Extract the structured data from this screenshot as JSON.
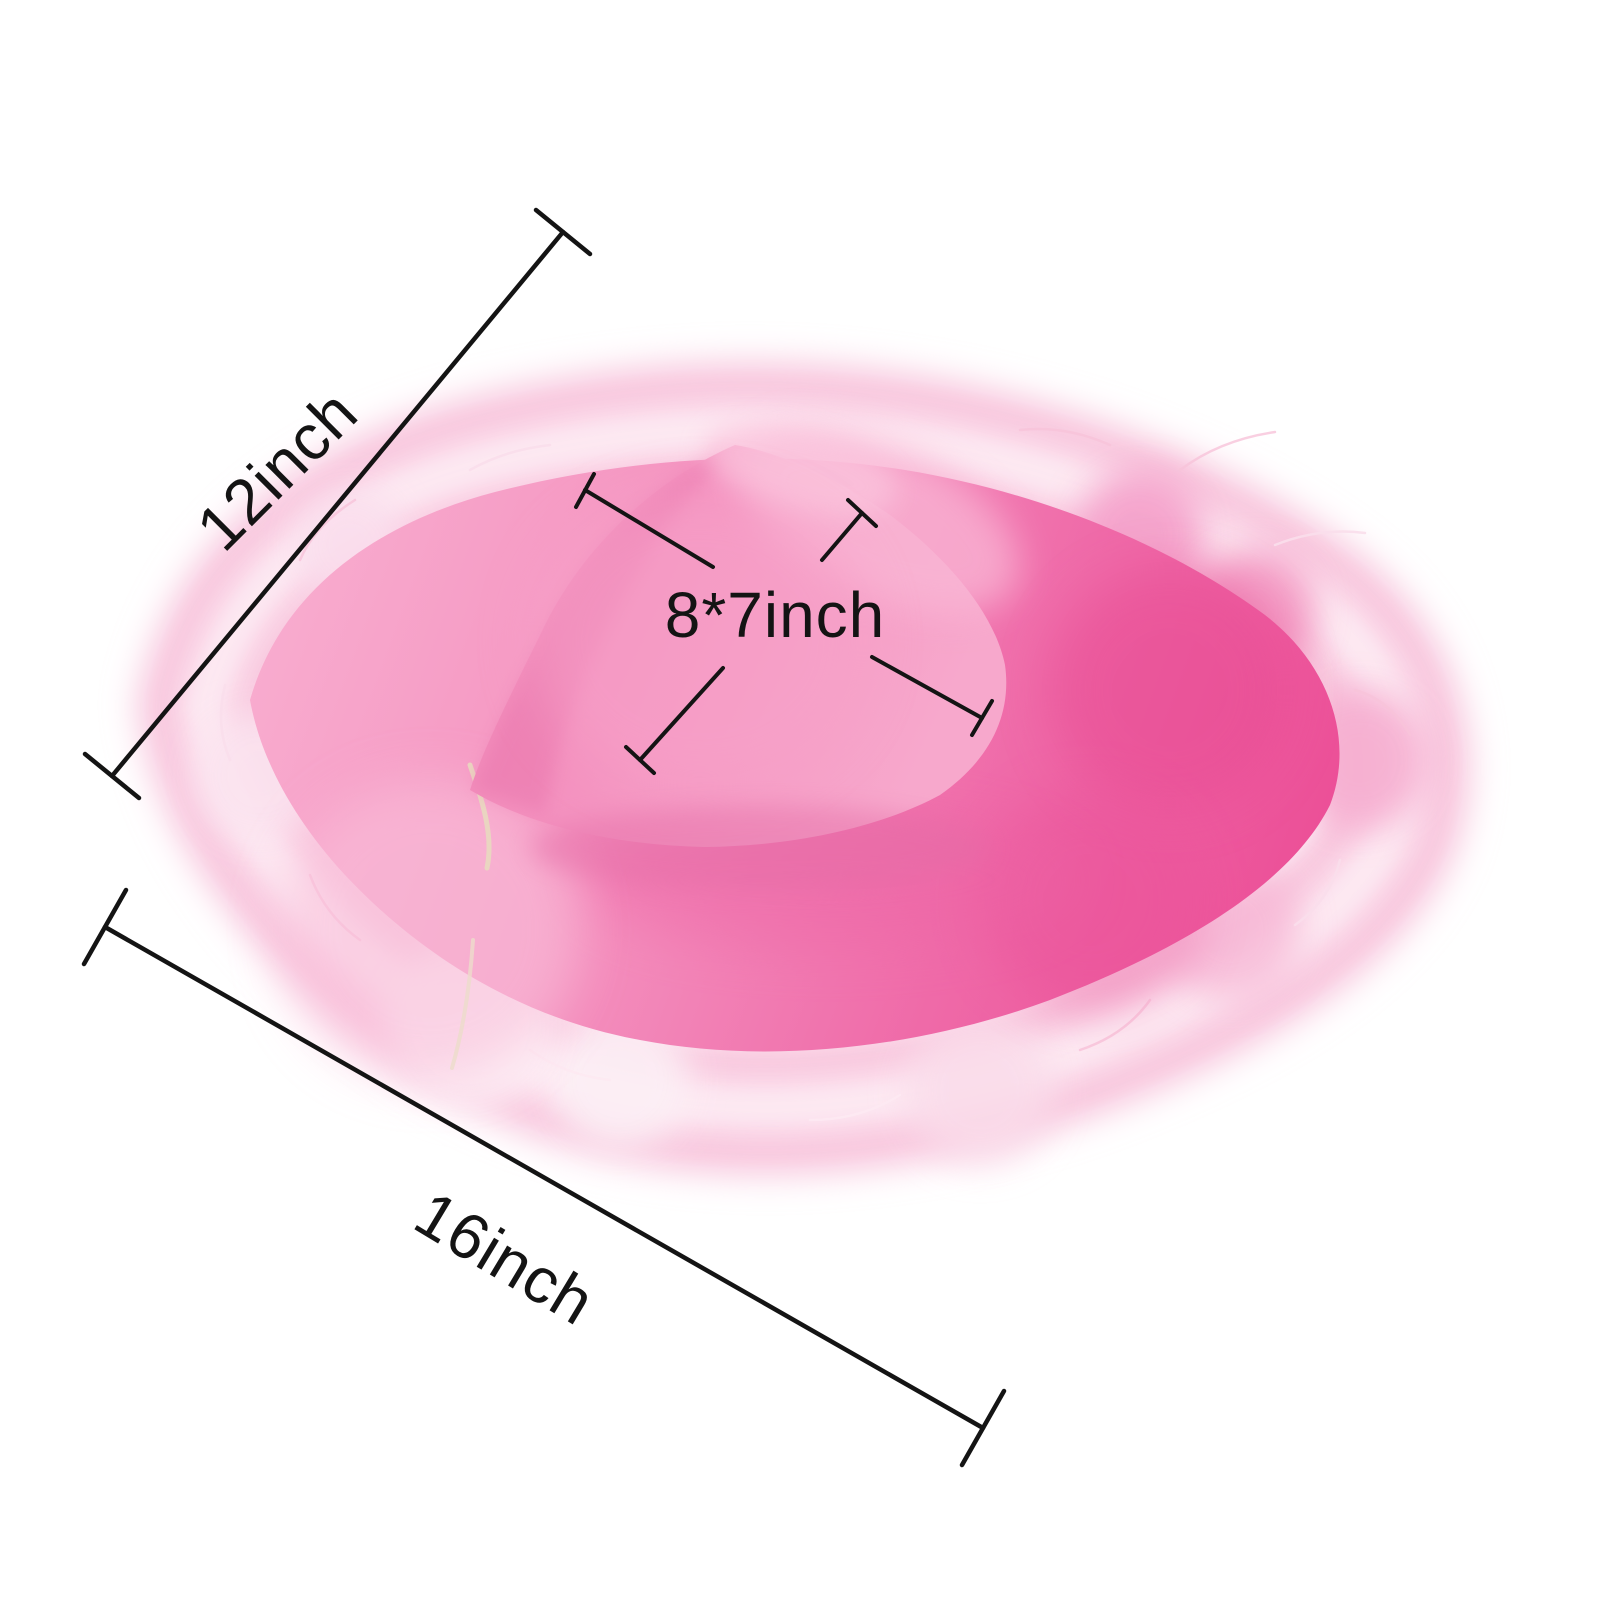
{
  "image": {
    "alt": "Pink cowboy hat with fluffy marabou feather trim on a white background, annotated with size measurements",
    "background": "#ffffff"
  },
  "annotations": {
    "line_color": "#141414",
    "text_color": "#141414",
    "brim_depth": {
      "label": "12inch"
    },
    "brim_width": {
      "label": "16inch"
    },
    "crown_size": {
      "label": "8*7inch"
    }
  },
  "hat_colors": {
    "crown_main": "#f590bd",
    "crown_highlight": "#f9b7d5",
    "crown_shadow": "#e873ab",
    "brim_left": "#f8abce",
    "brim_right": "#ec4f97",
    "feathers_light": "#fdeaf3",
    "feathers_mid": "#fbd8e8",
    "feathers_deep": "#f7bfd9",
    "cord": "#e9d7c0"
  }
}
